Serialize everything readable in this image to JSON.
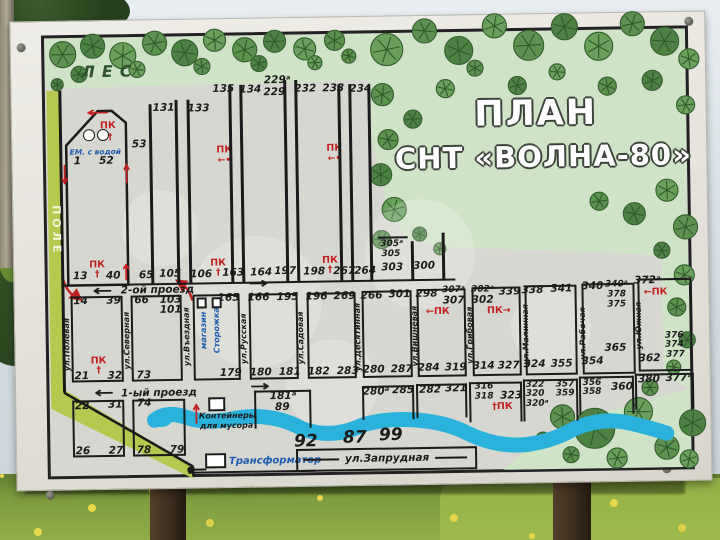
{
  "title": {
    "line1": "ПЛАН",
    "line2": "СНТ «ВОЛНА-80»"
  },
  "labels": {
    "forest": "ЛЕС",
    "field": "ПОЛЕ"
  },
  "map": {
    "texts": [
      {
        "t": "53",
        "x": 141,
        "y": 141,
        "c": "n"
      },
      {
        "t": "131",
        "x": 166,
        "y": 105,
        "c": "n"
      },
      {
        "t": "133",
        "x": 201,
        "y": 106,
        "c": "n"
      },
      {
        "t": "135",
        "x": 226,
        "y": 87,
        "c": "n"
      },
      {
        "t": "134",
        "x": 253,
        "y": 88,
        "c": "n"
      },
      {
        "t": "229ᵃ",
        "x": 280,
        "y": 79,
        "c": "n"
      },
      {
        "t": "229",
        "x": 277,
        "y": 91,
        "c": "n"
      },
      {
        "t": "232",
        "x": 308,
        "y": 88,
        "c": "n"
      },
      {
        "t": "233",
        "x": 336,
        "y": 88,
        "c": "n"
      },
      {
        "t": "234",
        "x": 363,
        "y": 89,
        "c": "n"
      },
      {
        "t": "ПК",
        "x": 226,
        "y": 148,
        "c": "red"
      },
      {
        "t": "←•",
        "x": 226,
        "y": 159,
        "c": "reds"
      },
      {
        "t": "ПК",
        "x": 336,
        "y": 148,
        "c": "red"
      },
      {
        "t": "←•",
        "x": 336,
        "y": 159,
        "c": "reds"
      },
      {
        "t": "ПК",
        "x": 110,
        "y": 122,
        "c": "red"
      },
      {
        "t": "†",
        "x": 112,
        "y": 134,
        "c": "reds"
      },
      {
        "t": "ЕМ. с водой",
        "x": 97,
        "y": 148,
        "c": "blue-i"
      },
      {
        "t": "1",
        "x": 79,
        "y": 157,
        "c": "n"
      },
      {
        "t": "52",
        "x": 108,
        "y": 157,
        "c": "n"
      },
      {
        "t": "13",
        "x": 80,
        "y": 272,
        "c": "n"
      },
      {
        "t": "ПК",
        "x": 97,
        "y": 261,
        "c": "red"
      },
      {
        "t": "†",
        "x": 97,
        "y": 271,
        "c": "reds"
      },
      {
        "t": "40",
        "x": 113,
        "y": 272,
        "c": "n"
      },
      {
        "t": "65",
        "x": 146,
        "y": 272,
        "c": "n"
      },
      {
        "t": "105",
        "x": 170,
        "y": 271,
        "c": "n"
      },
      {
        "t": "106",
        "x": 201,
        "y": 272,
        "c": "n"
      },
      {
        "t": "ПК",
        "x": 218,
        "y": 261,
        "c": "red"
      },
      {
        "t": "†",
        "x": 218,
        "y": 271,
        "c": "reds"
      },
      {
        "t": "163",
        "x": 233,
        "y": 271,
        "c": "n"
      },
      {
        "t": "164",
        "x": 261,
        "y": 271,
        "c": "n"
      },
      {
        "t": "197",
        "x": 285,
        "y": 270,
        "c": "n"
      },
      {
        "t": "198",
        "x": 314,
        "y": 271,
        "c": "n"
      },
      {
        "t": "ПК",
        "x": 330,
        "y": 260,
        "c": "red"
      },
      {
        "t": "†",
        "x": 330,
        "y": 270,
        "c": "reds"
      },
      {
        "t": "267",
        "x": 344,
        "y": 271,
        "c": "n"
      },
      {
        "t": "264",
        "x": 365,
        "y": 271,
        "c": "n"
      },
      {
        "t": "305ᵃ",
        "x": 392,
        "y": 245,
        "c": "n9"
      },
      {
        "t": "305",
        "x": 391,
        "y": 255,
        "c": "n9"
      },
      {
        "t": "303",
        "x": 392,
        "y": 268,
        "c": "n"
      },
      {
        "t": "300",
        "x": 424,
        "y": 267,
        "c": "n"
      },
      {
        "t": "2-ой проезд",
        "x": 157,
        "y": 287,
        "c": "road"
      },
      {
        "t": "1-ый проезд",
        "x": 157,
        "y": 390,
        "c": "road"
      },
      {
        "t": "ул.Запрудная",
        "x": 384,
        "y": 459,
        "c": "road"
      },
      {
        "t": "14",
        "x": 80,
        "y": 297,
        "c": "n"
      },
      {
        "t": "39",
        "x": 113,
        "y": 297,
        "c": "n"
      },
      {
        "t": "ПК",
        "x": 97,
        "y": 357,
        "c": "red"
      },
      {
        "t": "†",
        "x": 97,
        "y": 367,
        "c": "reds"
      },
      {
        "t": "21",
        "x": 80,
        "y": 372,
        "c": "n"
      },
      {
        "t": "32",
        "x": 113,
        "y": 372,
        "c": "n"
      },
      {
        "t": "66",
        "x": 141,
        "y": 297,
        "c": "n"
      },
      {
        "t": "103",
        "x": 170,
        "y": 297,
        "c": "n"
      },
      {
        "t": "101",
        "x": 170,
        "y": 307,
        "c": "n"
      },
      {
        "t": "73",
        "x": 142,
        "y": 372,
        "c": "n"
      },
      {
        "t": "165",
        "x": 228,
        "y": 296,
        "c": "n"
      },
      {
        "t": "179",
        "x": 229,
        "y": 371,
        "c": "n"
      },
      {
        "t": "166",
        "x": 258,
        "y": 296,
        "c": "n"
      },
      {
        "t": "195",
        "x": 287,
        "y": 296,
        "c": "n"
      },
      {
        "t": "180",
        "x": 259,
        "y": 371,
        "c": "n"
      },
      {
        "t": "181",
        "x": 288,
        "y": 371,
        "c": "n"
      },
      {
        "t": "196",
        "x": 316,
        "y": 296,
        "c": "n"
      },
      {
        "t": "269",
        "x": 344,
        "y": 296,
        "c": "n"
      },
      {
        "t": "182",
        "x": 317,
        "y": 371,
        "c": "n"
      },
      {
        "t": "283",
        "x": 346,
        "y": 371,
        "c": "n"
      },
      {
        "t": "266",
        "x": 371,
        "y": 296,
        "c": "n"
      },
      {
        "t": "301",
        "x": 399,
        "y": 295,
        "c": "n"
      },
      {
        "t": "280",
        "x": 372,
        "y": 370,
        "c": "n"
      },
      {
        "t": "287",
        "x": 400,
        "y": 370,
        "c": "n"
      },
      {
        "t": "298",
        "x": 426,
        "y": 295,
        "c": "n"
      },
      {
        "t": "307ᵃ",
        "x": 453,
        "y": 292,
        "c": "n9"
      },
      {
        "t": "307",
        "x": 453,
        "y": 302,
        "c": "n"
      },
      {
        "t": "←ПК",
        "x": 437,
        "y": 313,
        "c": "red"
      },
      {
        "t": "284",
        "x": 427,
        "y": 369,
        "c": "n"
      },
      {
        "t": "319",
        "x": 454,
        "y": 369,
        "c": "n"
      },
      {
        "t": "302ᵃ",
        "x": 482,
        "y": 292,
        "c": "n9"
      },
      {
        "t": "302",
        "x": 482,
        "y": 302,
        "c": "n"
      },
      {
        "t": "339",
        "x": 509,
        "y": 294,
        "c": "n"
      },
      {
        "t": "ПК→",
        "x": 498,
        "y": 313,
        "c": "red"
      },
      {
        "t": "314",
        "x": 482,
        "y": 368,
        "c": "n"
      },
      {
        "t": "327",
        "x": 507,
        "y": 368,
        "c": "n"
      },
      {
        "t": "338",
        "x": 532,
        "y": 293,
        "c": "n"
      },
      {
        "t": "341",
        "x": 561,
        "y": 292,
        "c": "n"
      },
      {
        "t": "324",
        "x": 533,
        "y": 367,
        "c": "n"
      },
      {
        "t": "355",
        "x": 560,
        "y": 367,
        "c": "n"
      },
      {
        "t": "340",
        "x": 592,
        "y": 290,
        "c": "n"
      },
      {
        "t": "340ᵃ",
        "x": 616,
        "y": 289,
        "c": "n9"
      },
      {
        "t": "378",
        "x": 616,
        "y": 299,
        "c": "n9"
      },
      {
        "t": "375",
        "x": 616,
        "y": 309,
        "c": "n9"
      },
      {
        "t": "365",
        "x": 614,
        "y": 352,
        "c": "n"
      },
      {
        "t": "354",
        "x": 591,
        "y": 365,
        "c": "n"
      },
      {
        "t": "372ᵃ",
        "x": 647,
        "y": 285,
        "c": "n"
      },
      {
        "t": "←ПК",
        "x": 655,
        "y": 297,
        "c": "red"
      },
      {
        "t": "376",
        "x": 673,
        "y": 341,
        "c": "n9"
      },
      {
        "t": "374",
        "x": 673,
        "y": 350,
        "c": "n9"
      },
      {
        "t": "377",
        "x": 674,
        "y": 360,
        "c": "n9"
      },
      {
        "t": "362",
        "x": 648,
        "y": 363,
        "c": "n"
      },
      {
        "t": "ул.Полевая",
        "x": 66,
        "y": 340,
        "c": "street"
      },
      {
        "t": "ул.Северная",
        "x": 126,
        "y": 337,
        "c": "street"
      },
      {
        "t": "ул.Въездная",
        "x": 186,
        "y": 334,
        "c": "street"
      },
      {
        "t": "магазин",
        "x": 203,
        "y": 328,
        "c": "vblue"
      },
      {
        "t": "Сторожка",
        "x": 216,
        "y": 328,
        "c": "vblue"
      },
      {
        "t": "ул.Русская",
        "x": 243,
        "y": 337,
        "c": "street"
      },
      {
        "t": "ул.Садовая",
        "x": 300,
        "y": 337,
        "c": "street"
      },
      {
        "t": "ул.Десятинная",
        "x": 357,
        "y": 337,
        "c": "street"
      },
      {
        "t": "ул.Вишневая",
        "x": 414,
        "y": 337,
        "c": "street"
      },
      {
        "t": "ул.Грибовая",
        "x": 469,
        "y": 337,
        "c": "street"
      },
      {
        "t": "ул.Малинная",
        "x": 525,
        "y": 337,
        "c": "street"
      },
      {
        "t": "ул.Рабочая",
        "x": 582,
        "y": 337,
        "c": "street"
      },
      {
        "t": "ул.Южная",
        "x": 638,
        "y": 330,
        "c": "street"
      },
      {
        "t": "22",
        "x": 80,
        "y": 402,
        "c": "n"
      },
      {
        "t": "31",
        "x": 113,
        "y": 401,
        "c": "n"
      },
      {
        "t": "26",
        "x": 80,
        "y": 447,
        "c": "n"
      },
      {
        "t": "27",
        "x": 113,
        "y": 447,
        "c": "n"
      },
      {
        "t": "74",
        "x": 142,
        "y": 400,
        "c": "n"
      },
      {
        "t": "78",
        "x": 141,
        "y": 447,
        "c": "n"
      },
      {
        "t": "79",
        "x": 174,
        "y": 447,
        "c": "n"
      },
      {
        "t": "Контейнеры",
        "x": 225,
        "y": 414,
        "c": "ni"
      },
      {
        "t": "для мусора",
        "x": 224,
        "y": 424,
        "c": "ni"
      },
      {
        "t": "181ᵃ",
        "x": 281,
        "y": 395,
        "c": "n"
      },
      {
        "t": "89",
        "x": 280,
        "y": 406,
        "c": "n"
      },
      {
        "t": "280ᵃ",
        "x": 374,
        "y": 392,
        "c": "n"
      },
      {
        "t": "285",
        "x": 401,
        "y": 391,
        "c": "n"
      },
      {
        "t": "282",
        "x": 428,
        "y": 391,
        "c": "n"
      },
      {
        "t": "321",
        "x": 454,
        "y": 390,
        "c": "n"
      },
      {
        "t": "316",
        "x": 482,
        "y": 389,
        "c": "n9"
      },
      {
        "t": "318",
        "x": 482,
        "y": 399,
        "c": "n9"
      },
      {
        "t": "323",
        "x": 509,
        "y": 398,
        "c": "n"
      },
      {
        "t": "†ПК",
        "x": 500,
        "y": 409,
        "c": "red"
      },
      {
        "t": "322",
        "x": 533,
        "y": 388,
        "c": "n9"
      },
      {
        "t": "320",
        "x": 533,
        "y": 397,
        "c": "n9"
      },
      {
        "t": "320ᵃ",
        "x": 535,
        "y": 407,
        "c": "n9"
      },
      {
        "t": "357",
        "x": 563,
        "y": 388,
        "c": "n9"
      },
      {
        "t": "359",
        "x": 563,
        "y": 397,
        "c": "n9"
      },
      {
        "t": "356",
        "x": 590,
        "y": 387,
        "c": "n9"
      },
      {
        "t": "358",
        "x": 590,
        "y": 396,
        "c": "n9"
      },
      {
        "t": "360",
        "x": 620,
        "y": 391,
        "c": "n"
      },
      {
        "t": "380",
        "x": 647,
        "y": 384,
        "c": "n"
      },
      {
        "t": "377ᵃ",
        "x": 677,
        "y": 383,
        "c": "n"
      },
      {
        "t": "Трансформатор",
        "x": 272,
        "y": 460,
        "c": "blue"
      },
      {
        "t": "92",
        "x": 303,
        "y": 441,
        "c": "wnum"
      },
      {
        "t": "87",
        "x": 352,
        "y": 438,
        "c": "wnum"
      },
      {
        "t": "99",
        "x": 388,
        "y": 436,
        "c": "wnum"
      }
    ],
    "boxes": [
      {
        "x": 70,
        "y": 292,
        "w": 52,
        "h": 86,
        "k": "plot"
      },
      {
        "x": 130,
        "y": 292,
        "w": 51,
        "h": 86,
        "k": "plot"
      },
      {
        "x": 192,
        "y": 292,
        "w": 47,
        "h": 86,
        "k": "plot"
      },
      {
        "x": 248,
        "y": 292,
        "w": 49,
        "h": 86,
        "k": "plot"
      },
      {
        "x": 306,
        "y": 292,
        "w": 49,
        "h": 86,
        "k": "plot"
      },
      {
        "x": 361,
        "y": 291,
        "w": 50,
        "h": 87,
        "k": "plot"
      },
      {
        "x": 416,
        "y": 290,
        "w": 49,
        "h": 88,
        "k": "plot"
      },
      {
        "x": 471,
        "y": 289,
        "w": 49,
        "h": 89,
        "k": "plot"
      },
      {
        "x": 524,
        "y": 288,
        "w": 52,
        "h": 90,
        "k": "plot"
      },
      {
        "x": 581,
        "y": 287,
        "w": 53,
        "h": 91,
        "k": "plot"
      },
      {
        "x": 637,
        "y": 283,
        "w": 54,
        "h": 93,
        "k": "plot"
      },
      {
        "x": 70,
        "y": 396,
        "w": 52,
        "h": 57,
        "k": "plot"
      },
      {
        "x": 130,
        "y": 396,
        "w": 53,
        "h": 57,
        "k": "plot"
      },
      {
        "x": 252,
        "y": 389,
        "w": 57,
        "h": 38,
        "k": "plot-ob"
      },
      {
        "x": 360,
        "y": 386,
        "w": 52,
        "h": 34,
        "k": "plot-ob"
      },
      {
        "x": 414,
        "y": 385,
        "w": 51,
        "h": 34,
        "k": "plot-ob"
      },
      {
        "x": 467,
        "y": 384,
        "w": 53,
        "h": 40,
        "k": "plot-ob"
      },
      {
        "x": 521,
        "y": 382,
        "w": 55,
        "h": 42,
        "k": "plot-ob"
      },
      {
        "x": 577,
        "y": 380,
        "w": 55,
        "h": 38,
        "k": "plot-ob"
      },
      {
        "x": 633,
        "y": 378,
        "w": 59,
        "h": 36,
        "k": "plot-ob"
      },
      {
        "x": 206,
        "y": 395,
        "w": 17,
        "h": 14,
        "k": "white"
      },
      {
        "x": 202,
        "y": 451,
        "w": 21,
        "h": 15,
        "k": "white"
      },
      {
        "x": 196,
        "y": 295,
        "w": 10,
        "h": 11,
        "k": "white"
      },
      {
        "x": 211,
        "y": 295,
        "w": 10,
        "h": 11,
        "k": "white"
      },
      {
        "x": 293,
        "y": 448,
        "w": 181,
        "h": 23,
        "k": "plot"
      }
    ],
    "lines": [
      {
        "x1": 152,
        "y1": 101,
        "x2": 152,
        "y2": 281
      },
      {
        "x1": 178,
        "y1": 97,
        "x2": 178,
        "y2": 281
      },
      {
        "x1": 190,
        "y1": 97,
        "x2": 190,
        "y2": 281
      },
      {
        "x1": 232,
        "y1": 83,
        "x2": 232,
        "y2": 281
      },
      {
        "x1": 243,
        "y1": 83,
        "x2": 243,
        "y2": 281
      },
      {
        "x1": 287,
        "y1": 79,
        "x2": 287,
        "y2": 281
      },
      {
        "x1": 298,
        "y1": 79,
        "x2": 298,
        "y2": 281
      },
      {
        "x1": 341,
        "y1": 84,
        "x2": 341,
        "y2": 281
      },
      {
        "x1": 352,
        "y1": 84,
        "x2": 352,
        "y2": 281
      },
      {
        "x1": 371,
        "y1": 86,
        "x2": 371,
        "y2": 281
      },
      {
        "x1": 412,
        "y1": 242,
        "x2": 412,
        "y2": 281
      },
      {
        "x1": 443,
        "y1": 234,
        "x2": 443,
        "y2": 281
      },
      {
        "x1": 378,
        "y1": 238,
        "x2": 408,
        "y2": 238
      },
      {
        "x1": 62,
        "y1": 281,
        "x2": 455,
        "y2": 281
      },
      {
        "x1": 62,
        "y1": 86,
        "x2": 62,
        "y2": 388
      },
      {
        "x1": 185,
        "y1": 470,
        "x2": 312,
        "y2": 470
      },
      {
        "x1": 300,
        "y1": 459,
        "x2": 336,
        "y2": 459
      },
      {
        "x1": 432,
        "y1": 459,
        "x2": 464,
        "y2": 459
      },
      {
        "x1": 187,
        "y1": 467,
        "x2": 203,
        "y2": 467
      }
    ],
    "arrows": [
      {
        "g": "←",
        "x": 102,
        "y": 287,
        "col": "#1b1b1b",
        "fs": 15,
        "sx": 1.6,
        "sy": 1
      },
      {
        "g": "→",
        "x": 258,
        "y": 282,
        "col": "#1b1b1b",
        "fs": 15,
        "sx": 1.6,
        "sy": 1
      },
      {
        "g": "←",
        "x": 102,
        "y": 389,
        "col": "#1b1b1b",
        "fs": 15,
        "sx": 1.6,
        "sy": 1
      },
      {
        "g": "→",
        "x": 258,
        "y": 385,
        "col": "#1b1b1b",
        "fs": 15,
        "sx": 1.6,
        "sy": 1
      },
      {
        "g": "↑",
        "x": 126,
        "y": 270,
        "col": "#c32222",
        "fs": 15,
        "sx": 1,
        "sy": 1.5
      },
      {
        "g": "↑",
        "x": 194,
        "y": 413,
        "col": "#c32222",
        "fs": 15,
        "sx": 1,
        "sy": 1.8
      },
      {
        "g": "←",
        "x": 100,
        "y": 109,
        "col": "#c32222",
        "fs": 14,
        "sx": 2.0,
        "sy": 1
      },
      {
        "g": "↓",
        "x": 66,
        "y": 172,
        "col": "#c32222",
        "fs": 14,
        "sx": 1,
        "sy": 1.9
      },
      {
        "g": "↑",
        "x": 128,
        "y": 172,
        "col": "#c32222",
        "fs": 14,
        "sx": 1,
        "sy": 1.9
      }
    ],
    "circles": [
      {
        "x": 91,
        "y": 131,
        "r": 6,
        "f": "#ffffff"
      },
      {
        "x": 105,
        "y": 131,
        "r": 6,
        "f": "#ffffff"
      },
      {
        "x": 187,
        "y": 467,
        "r": 3,
        "f": "#1b1b1b"
      }
    ],
    "colors": {
      "water": "#2ab2dc",
      "forest": "#cfe3c6",
      "field_strip": "#b5c94e",
      "line": "#1b1b1b",
      "red": "#c32222",
      "blue": "#1d5cb0"
    }
  }
}
